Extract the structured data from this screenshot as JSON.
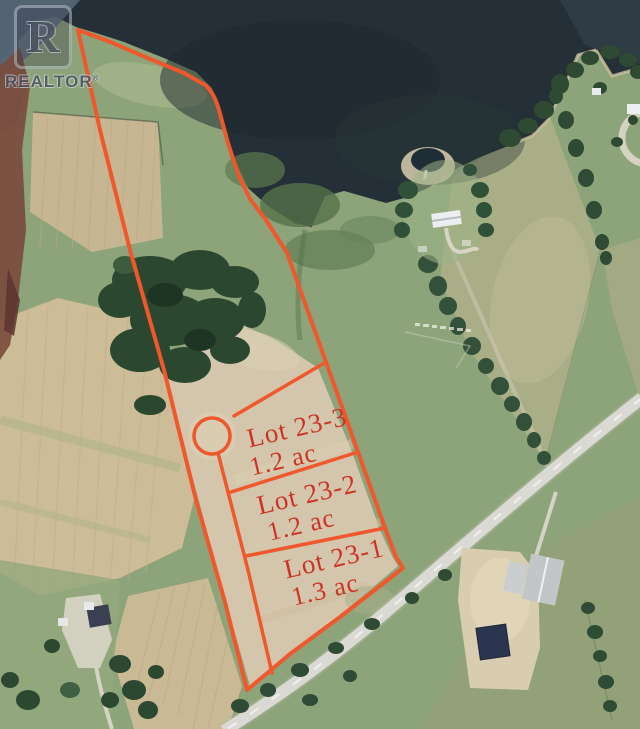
{
  "watermark": {
    "logo_letter": "R",
    "brand": "REALTOR",
    "registered": "®"
  },
  "lots": [
    {
      "name": "Lot 23-3",
      "area": "1.2 ac"
    },
    {
      "name": "Lot 23-2",
      "area": "1.2 ac"
    },
    {
      "name": "Lot 23-1",
      "area": "1.3 ac"
    }
  ],
  "colors": {
    "boundary": "#f0572c",
    "label_text": "#cd3224",
    "water": "#242f37",
    "field_tan": "#ccbc97",
    "grass_green": "#8da379",
    "road": "#d8d7d0"
  }
}
